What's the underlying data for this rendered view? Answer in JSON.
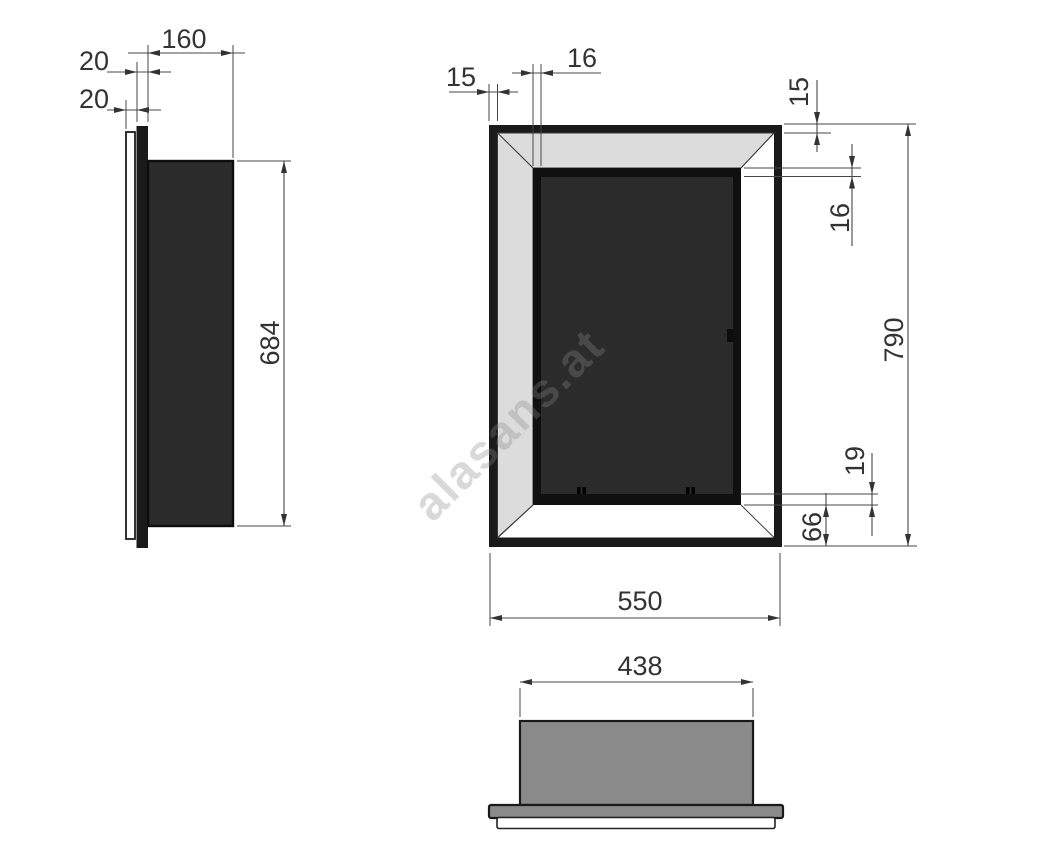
{
  "watermark": {
    "text": "alasans.at"
  },
  "dimensions": {
    "side": {
      "depth": "160",
      "frame_depth": "20",
      "flange_offset": "20",
      "body_height": "684"
    },
    "front": {
      "frame_profile_left": "15",
      "inner_frame_left": "16",
      "frame_profile_top": "15",
      "inner_frame_top": "16",
      "overall_height": "790",
      "burner_inset": "19",
      "bottom_clearance": "66",
      "overall_width": "550"
    },
    "bottom": {
      "body_width": "438"
    }
  },
  "colors": {
    "frame": "#1a1a1a",
    "interior": "#2b2b2b",
    "bevel": "#dcdcdc",
    "body_gray": "#8a8a8a",
    "watermark": "#8a8a8a"
  }
}
